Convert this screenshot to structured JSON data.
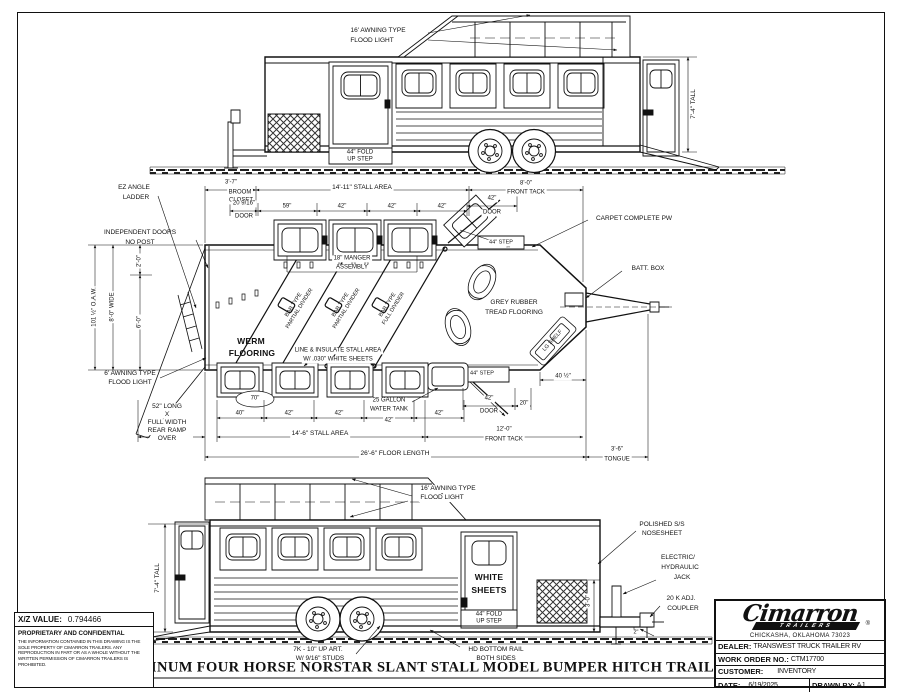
{
  "page": {
    "title": "ALUMINUM FOUR HORSE NORSTAR SLANT STALL MODEL BUMPER HITCH TRAILER",
    "line_color": "#1a1a1a",
    "background": "#ffffff"
  },
  "top_view": {
    "flood_light_1": "16' AWNING TYPE",
    "flood_light_2": "FLOOD LIGHT",
    "fold_step_1": "44\" FOLD",
    "fold_step_2": "UP STEP",
    "height_dim": "7'-4\" TALL"
  },
  "plan_view": {
    "ez_ladder_1": "EZ ANGLE",
    "ez_ladder_2": "LADDER",
    "independent_doors_1": "INDEPENDENT DOORS",
    "independent_doors_2": "NO POST",
    "oaw_dim": "101 ½\" O.A.W.",
    "wide_dim": "8'-0\" WIDE",
    "dim_2ft": "2'-0\"",
    "dim_6ft": "6'-0\"",
    "awning_6_1": "6' AWNING TYPE",
    "awning_6_2": "FLOOD LIGHT",
    "ramp_note_1": "52\" LONG",
    "ramp_note_2": "X",
    "ramp_note_3": "FULL WIDTH",
    "ramp_note_4": "REAR RAMP",
    "ramp_note_5": "OVER",
    "broom_dim": "3'-7\"",
    "broom_1": "BROOM",
    "broom_2": "CLOSET",
    "stall_area_top": "14'-11\" STALL AREA",
    "front_tack_top_1": "8'-0\"",
    "front_tack_top_2": "FRONT TACK",
    "door_2016_1": "20 9/16\"",
    "door_2016_2": "DOOR",
    "dim_59": "59\"",
    "dim_42a": "42\"",
    "dim_42b": "42\"",
    "dim_42c": "42\"",
    "door_42_top_1": "42\"",
    "door_42_top_2": "DOOR",
    "carpet_note": "CARPET COMPLETE PW",
    "step_44_top": "44\" STEP",
    "batt_box": "BATT. BOX",
    "manger_1": "18\" MANGER",
    "manger_2": "ASSEMBLY",
    "divider1_1": "BAR TYPE",
    "divider1_2": "PARTIAL DIVIDER",
    "divider2_1": "BAR TYPE",
    "divider2_2": "PARTIAL DIVIDER",
    "divider3_1": "BAR TYPE",
    "divider3_2": "FULL DIVIDER",
    "werm_1": "WERM",
    "werm_2": "FLOORING",
    "line_insulate_1": "LINE & INSULATE STALL AREA",
    "line_insulate_2": "W/ .030\" WHITE SHEETS",
    "grey_rubber_1": "GREY RUBBER",
    "grey_rubber_2": "TREAD FLOORING",
    "lg_shelf": "LG SHELF",
    "step_44_bottom": "44\" STEP",
    "dim_70": "70\"",
    "water_tank_1": "25 GALLON",
    "water_tank_2": "WATER TANK",
    "dim_40": "40\"",
    "dim_42d": "42\"",
    "dim_42e": "42\"",
    "dim_42f": "42\"",
    "dim_42g": "42\"",
    "door_42_bottom_1": "42\"",
    "door_42_bottom_2": "DOOR",
    "dim_20": "20\"",
    "dim_40_5": "40 ½\"",
    "stall_area_bottom": "14'-6\" STALL AREA",
    "front_tack_bottom_1": "12'-0\"",
    "front_tack_bottom_2": "FRONT TACK",
    "floor_length": "26'-6\" FLOOR LENGTH",
    "tongue_1": "3'-6\"",
    "tongue_2": "TONGUE"
  },
  "bottom_view": {
    "flood_light_1": "16' AWNING TYPE",
    "flood_light_2": "FLOOD LIGHT",
    "height_dim": "7'-4\" TALL",
    "white_sheets_1": "WHITE",
    "white_sheets_2": "SHEETS",
    "fold_step_1": "44\" FOLD",
    "fold_step_2": "UP STEP",
    "nosesheet_1": "POLISHED S/S",
    "nosesheet_2": "NOSESHEET",
    "jack_1": "ELECTRIC/",
    "jack_2": "HYDRAULIC",
    "jack_3": "JACK",
    "coupler_1": "20 K ADJ.",
    "coupler_2": "COUPLER",
    "dim_3ft": "3'-0\"",
    "dim_2in": "2\"",
    "axle_note_1": "7K - 10\" UP ART.",
    "axle_note_2": "W/ 9/16\" STUDS",
    "bottom_rail_1": "HD BOTTOM RAIL",
    "bottom_rail_2": "BOTH SIDES"
  },
  "info_box": {
    "xz_label": "X/Z VALUE:",
    "xz_value": "0.794466",
    "confidential_title": "PROPRIETARY AND CONFIDENTIAL",
    "confidential_body": "THE INFORMATION CONTAINED IN THIS DRAWING IS THE SOLE PROPERTY OF CIMARRON TRAILERS.  ANY REPRODUCTION IN PART OR AS A WHOLE WITHOUT THE WRITTEN PERMISSION OF CIMARRON TRAILERS IS PROHIBITED.",
    "brand_stamp": "Cimarron"
  },
  "title_block": {
    "brand": "Cimarron",
    "brand_sub": "TRAILERS",
    "registered": "®",
    "address": "CHICKASHA, OKLAHOMA 73023",
    "dealer_label": "DEALER:",
    "dealer_value": "TRANSWEST TRUCK TRAILER RV",
    "work_order_label": "WORK ORDER NO.:",
    "work_order_value": "CTM17700",
    "customer_label": "CUSTOMER:",
    "customer_value": "INVENTORY",
    "date_label": "DATE:",
    "date_value": "6/19/2025",
    "drawn_label": "DRAWN BY:",
    "drawn_value": "AJ"
  }
}
